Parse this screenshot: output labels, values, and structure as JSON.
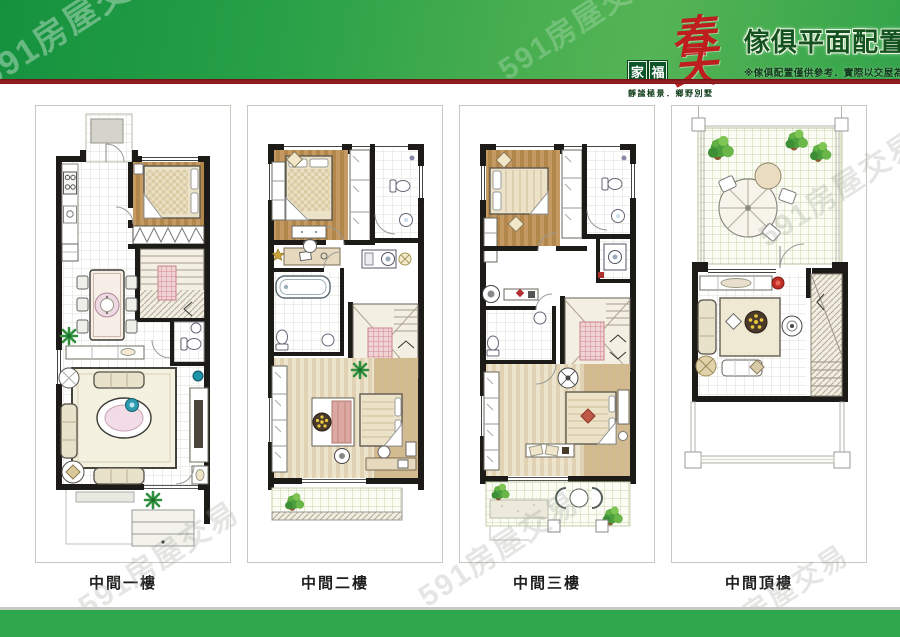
{
  "header": {
    "logo_char_1": "家",
    "logo_char_2": "福",
    "logo_script": "春天",
    "tagline": "靜謐極景．鄉野別墅",
    "title": "傢俱平面配置圖",
    "subtitle": "※傢俱配置僅供參考．實際以交屋為主"
  },
  "panels": [
    {
      "id": "floor-1",
      "label": "中間一樓"
    },
    {
      "id": "floor-2",
      "label": "中間二樓"
    },
    {
      "id": "floor-3",
      "label": "中間三樓"
    },
    {
      "id": "floor-roof",
      "label": "中間頂樓"
    }
  ],
  "watermark": {
    "text": "591房屋交易"
  },
  "colors": {
    "banner_green_dark": "#15913e",
    "banner_green_light": "#55b455",
    "divider_red": "#9e2025",
    "footer_green": "#2fa84d",
    "logo_red": "#bf1e1f",
    "logo_box_green": "#0c5429",
    "title_green": "#14531f",
    "wall_black": "#1d1b18",
    "wood_floor": "#b8905a",
    "plant_green": "#2e8f3c"
  }
}
